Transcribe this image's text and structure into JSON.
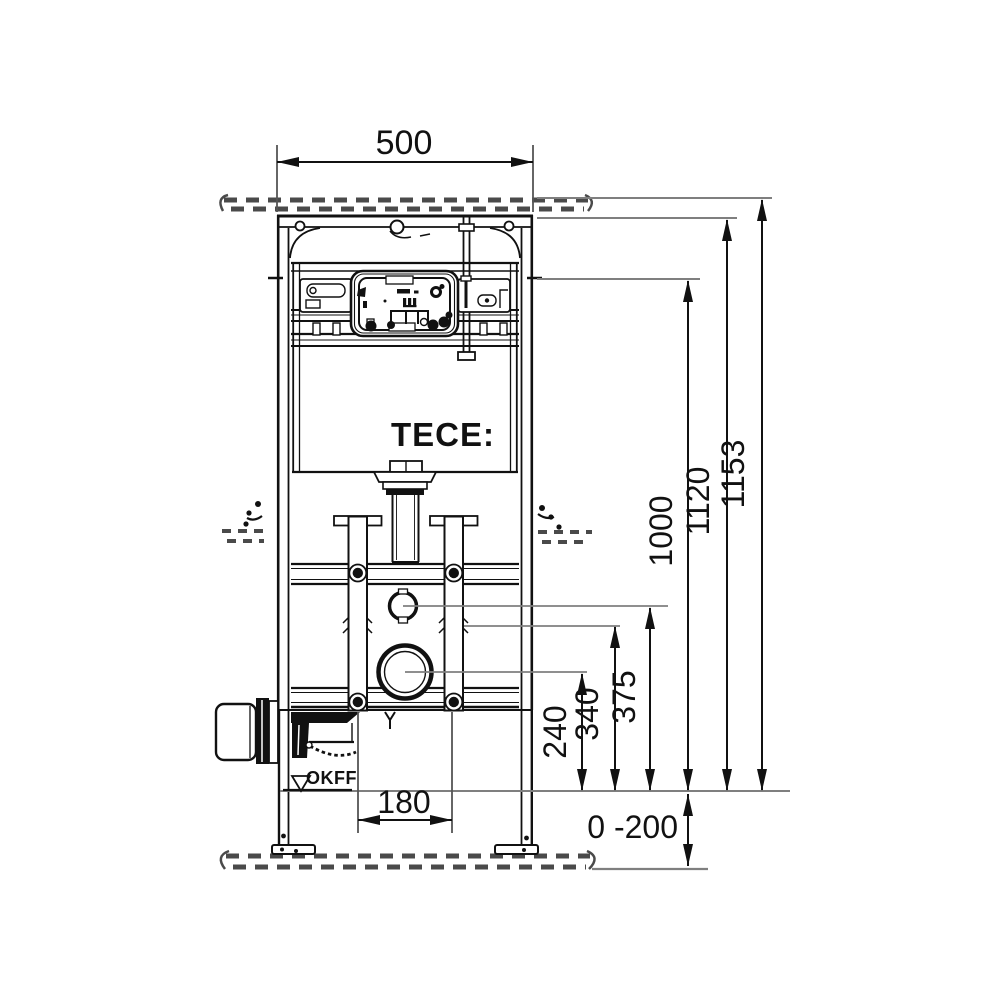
{
  "drawing": {
    "brand_logo": "TECE:",
    "dimensions": {
      "frame_width": "500",
      "total_height": "1153",
      "top_edge_height": "1120",
      "actuation_height": "1000",
      "flush_connection_height": "375",
      "rail_fixing_height": "340",
      "drain_center_height": "240",
      "fixing_spacing": "180",
      "floor_adjust_range": "0 -200"
    },
    "labels": {
      "floor_level": "OKFF"
    },
    "colors": {
      "line": "#111111",
      "extension_line": "#7f7f7f",
      "background": "#ffffff"
    }
  }
}
